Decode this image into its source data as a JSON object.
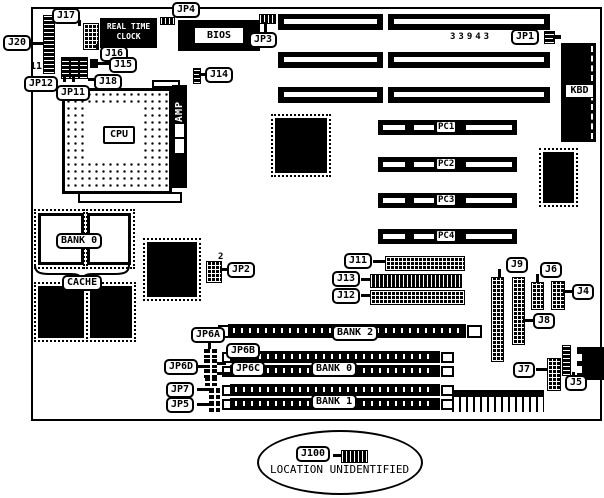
{
  "title": "Motherboard jumper and connector location diagram",
  "board": {
    "part_number": "33943",
    "pin_label_11": "11",
    "jp2_pin_label": "2"
  },
  "chips": {
    "cpu": "CPU",
    "bios": "BIOS",
    "rtc_line1": "REAL TIME",
    "rtc_line2": "CLOCK",
    "kbd": "KBD",
    "amp": "AMP"
  },
  "slots": {
    "pc1": "PC1",
    "pc2": "PC2",
    "pc3": "PC3",
    "pc4": "PC4"
  },
  "memory": {
    "cache_bank": "BANK 0",
    "cache": "CACHE",
    "bank2": "BANK 2",
    "bank0": "BANK 0",
    "bank1": "BANK 1"
  },
  "connectors": {
    "j20": "J20",
    "j17": "J17",
    "jp4": "JP4",
    "jp12": "JP12",
    "jp11": "JP11",
    "j18": "J18",
    "j16": "J16",
    "j15": "J15",
    "j14": "J14",
    "jp3": "JP3",
    "jp1": "JP1",
    "jp2": "JP2",
    "j11": "J11",
    "j13": "J13",
    "j12": "J12",
    "j9": "J9",
    "j8": "J8",
    "j6": "J6",
    "j4": "J4",
    "j7": "J7",
    "j5": "J5",
    "jp6a": "JP6A",
    "jp6b": "JP6B",
    "jp6c": "JP6C",
    "jp6d": "JP6D",
    "jp7": "JP7",
    "jp5": "JP5",
    "j100": "J100"
  },
  "note": {
    "text": "LOCATION UNIDENTIFIED"
  },
  "colors": {
    "ink": "#000000",
    "paper": "#ffffff"
  }
}
